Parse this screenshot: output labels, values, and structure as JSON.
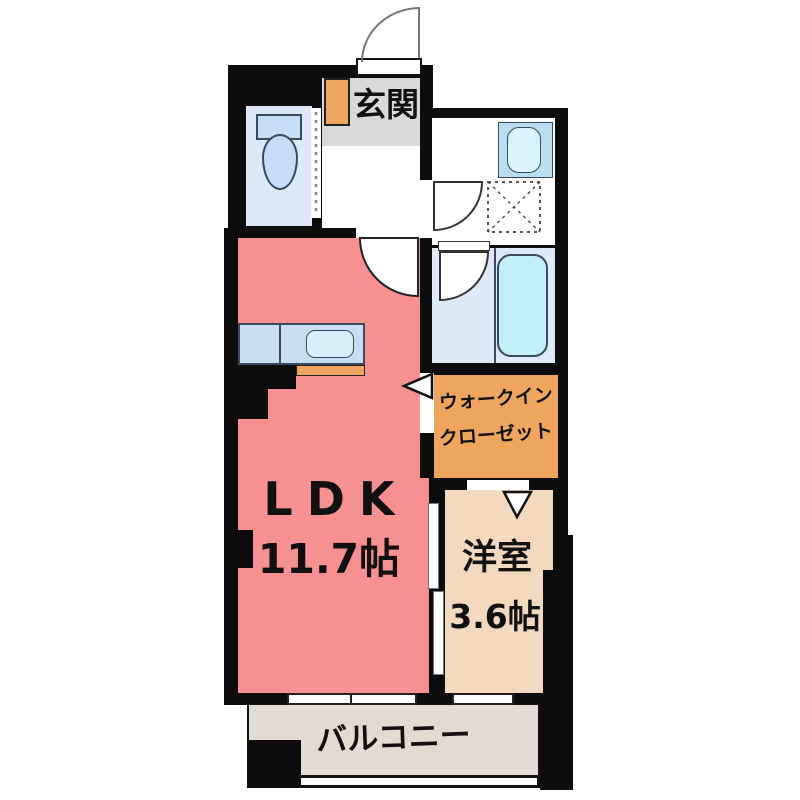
{
  "plan": {
    "type": "apartment-floor-plan",
    "rooms": {
      "genkan": {
        "name": "玄関"
      },
      "ldk": {
        "name": "LDK",
        "area": "11.7帖"
      },
      "western_room": {
        "name": "洋室",
        "area": "3.6帖"
      },
      "walk_in_closet": {
        "name_line1": "ウォークイン",
        "name_line2": "クローゼット"
      },
      "balcony": {
        "name": "バルコニー"
      },
      "toilet": {
        "fixture": "toilet-icon"
      },
      "washroom": {
        "fixtures": [
          "sink-icon",
          "washer-pan-icon"
        ]
      },
      "bathroom": {
        "fixture": "bathtub-icon"
      },
      "kitchen": {
        "fixture": "kitchen-counter-with-sink"
      }
    },
    "colors": {
      "wall": "#0d0d0d",
      "ldk_floor": "#f79090",
      "western_room_floor": "#f3d9be",
      "walk_in_closet_floor": "#efa55e",
      "balcony_floor": "#e0dcd2",
      "genkan_floor": "#d9d9d9",
      "toilet_floor": "#dbe9f8",
      "washroom_floor": "#ffffff",
      "bath_floor": "#dde9f6",
      "bathtub": "#c3eff9",
      "kitchen_counter": "#cadef2",
      "fixture_blue": "#b9def1",
      "accent_orange": "#efa55e"
    },
    "fixtures": [
      "entrance-door-arc",
      "toilet-icon",
      "shoe-cabinet",
      "sink-icon",
      "washer-pan-icon",
      "bathtub-icon",
      "kitchen-counter-with-sink",
      "washroom-door-arc",
      "bath-door-arc",
      "ldk-door-arc",
      "sliding-door",
      "window-ldk",
      "window-western-room",
      "wic-entry-arrow",
      "western-room-entry-arrow",
      "balcony-railing"
    ]
  }
}
